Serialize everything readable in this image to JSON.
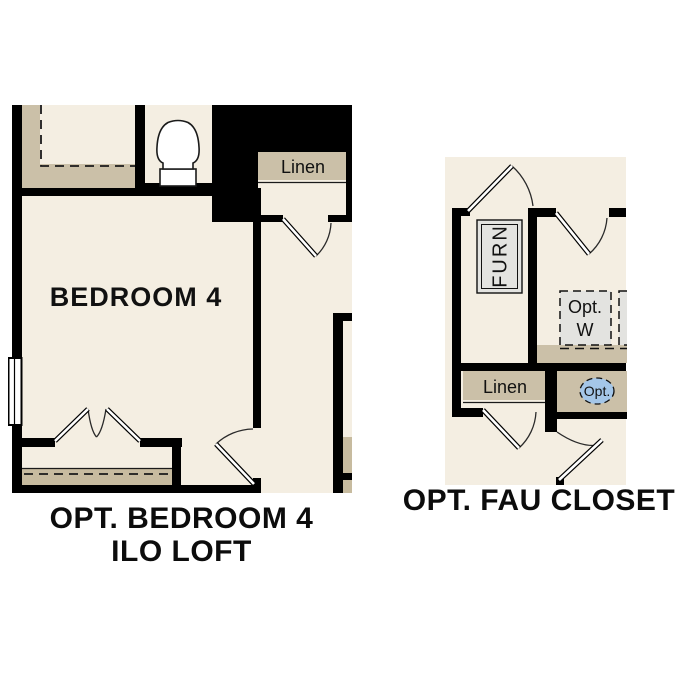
{
  "sheet": {
    "title": "Optional floor plan details",
    "colors": {
      "background": "#ffffff",
      "floor": "#f4eee2",
      "shelf_tan": "#cbc0a8",
      "closet_tan": "#c7bb9f",
      "fixture_gray": "#e3e3e0",
      "callout_blue": "#a4c6e8",
      "wall": "#000000"
    }
  },
  "left_plan": {
    "caption_line1": "OPT. BEDROOM 4",
    "caption_line2": "ILO LOFT",
    "room_label": "BEDROOM 4",
    "linen_label": "Linen"
  },
  "right_plan": {
    "caption": "OPT. FAU CLOSET",
    "furnace_label": "FURN",
    "linen_label": "Linen",
    "optional_washer_line1": "Opt.",
    "optional_washer_line2": "W",
    "optional_callout": "Opt."
  }
}
